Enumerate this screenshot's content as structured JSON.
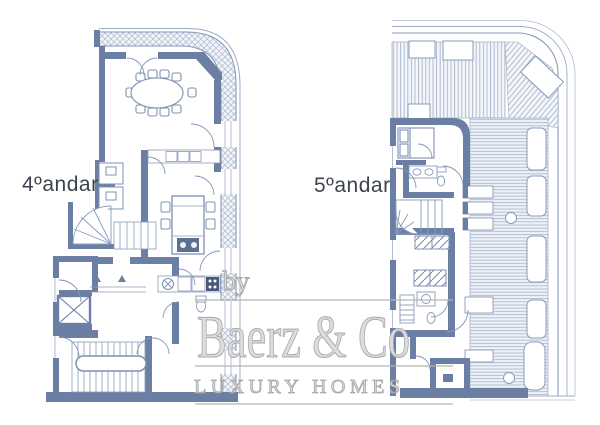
{
  "page": {
    "background": "#ffffff",
    "description_label": "scanned two-storey apartment floor plan"
  },
  "floor_plans": [
    {
      "label": "4ºandar"
    },
    {
      "label": "5ºandar"
    }
  ],
  "watermark": {
    "prefix": "by",
    "brand": "Baerz & Co",
    "tagline": "LUXURY HOMES"
  },
  "colors": {
    "wall": "#6b7fa4",
    "thin_line": "#8a9cba",
    "hatch_line": "#b7c3d8",
    "terrace_stripe": "#a8b6cd",
    "label_text": "#3d434b",
    "watermark_gray": "#b5b5b5"
  }
}
